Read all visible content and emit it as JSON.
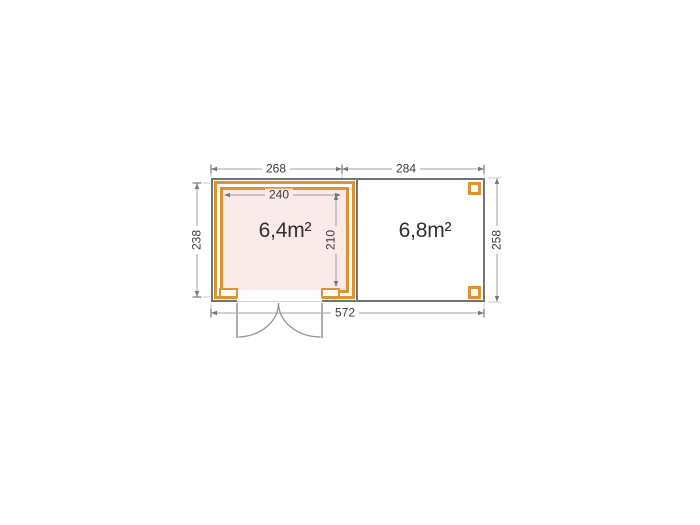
{
  "plan": {
    "type": "floor-plan",
    "rooms": [
      {
        "id": "cabin",
        "area": "6,4m²"
      },
      {
        "id": "canopy",
        "area": "6,8m²"
      }
    ],
    "dims": {
      "cabin_width": "268",
      "canopy_width": "284",
      "cabin_inner_width": "240",
      "cabin_depth": "238",
      "cabin_inner_depth": "210",
      "overall_depth": "258",
      "overall_width": "572"
    },
    "colors": {
      "wall": "#DE9232",
      "cabin_fill": "#FAE9E9",
      "outline": "#70757A",
      "dim_line": "#9CA0A4",
      "text": "#3B3B3F"
    }
  }
}
